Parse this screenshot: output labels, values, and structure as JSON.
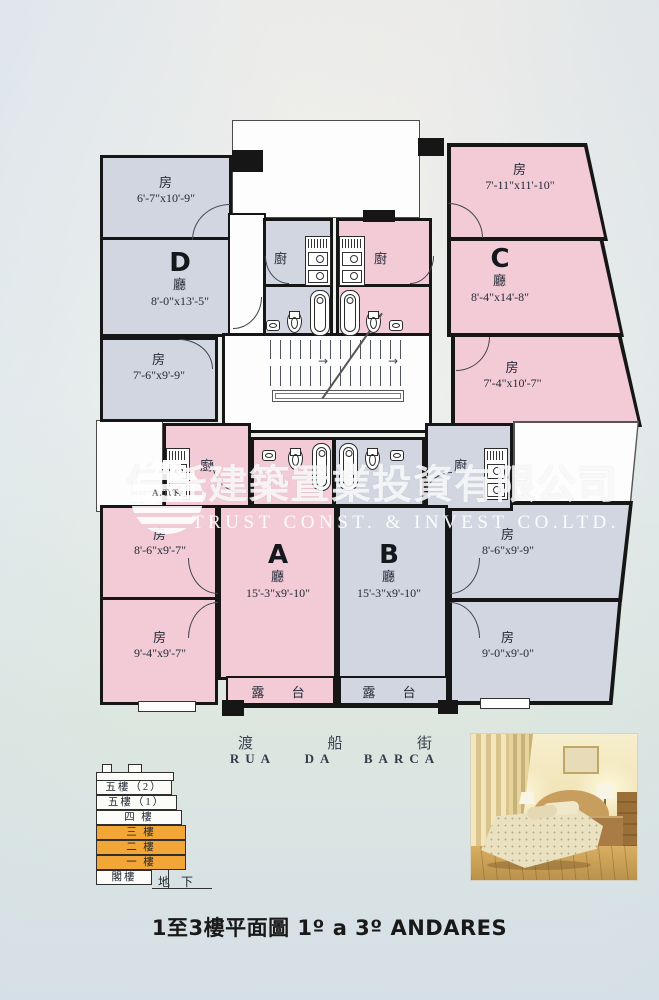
{
  "page": {
    "caption": "1至3樓平面圖 1º a 3º ANDARES",
    "street": {
      "cn1": "渡",
      "cn2": "船",
      "cn3": "街",
      "latin": "RUA DA BARCA"
    }
  },
  "watermark": {
    "cn": "信託建築置業投資有限公司",
    "en": "TRUST CONST. & INVEST CO.LTD.",
    "logo": "A.T.T."
  },
  "units": {
    "D": {
      "letter": "D",
      "hall": "廳",
      "hall_dims": "8'-0\"x13'-5\"",
      "room1": "房",
      "room1_dims": "6'-7\"x10'-9\"",
      "room2": "房",
      "room2_dims": "7'-6\"x9'-9\"",
      "kitchen": "廚"
    },
    "C": {
      "letter": "C",
      "hall": "廳",
      "hall_dims": "8'-4\"x14'-8\"",
      "room1": "房",
      "room1_dims": "7'-11\"x11'-10\"",
      "room2": "房",
      "room2_dims": "7'-4\"x10'-7\"",
      "kitchen": "廚"
    },
    "A": {
      "letter": "A",
      "hall": "廳",
      "hall_dims": "15'-3\"x9'-10\"",
      "room1": "房",
      "room1_dims": "8'-6\"x9'-7\"",
      "room2": "房",
      "room2_dims": "9'-4\"x9'-7\"",
      "kitchen": "廚",
      "balcony": "露 台"
    },
    "B": {
      "letter": "B",
      "hall": "廳",
      "hall_dims": "15'-3\"x9'-10\"",
      "room1": "房",
      "room1_dims": "8'-6\"x9'-9\"",
      "room2": "房",
      "room2_dims": "9'-0\"x9'-0\"",
      "kitchen": "廚",
      "balcony": "露 台"
    }
  },
  "legend": {
    "floors": [
      {
        "label": "五樓（2）",
        "highlight": false
      },
      {
        "label": "五樓（1）",
        "highlight": false
      },
      {
        "label": "四 樓",
        "highlight": false
      },
      {
        "label": "三 樓",
        "highlight": true
      },
      {
        "label": "二 樓",
        "highlight": true
      },
      {
        "label": "一 樓",
        "highlight": true
      },
      {
        "label": "閣樓",
        "highlight": false
      }
    ],
    "ground": "地 下"
  },
  "colors": {
    "unit_pink": "#f3cbd6",
    "unit_grey": "#d1d6e1",
    "legend_highlight": "#f1a637",
    "wall": "#161616"
  }
}
